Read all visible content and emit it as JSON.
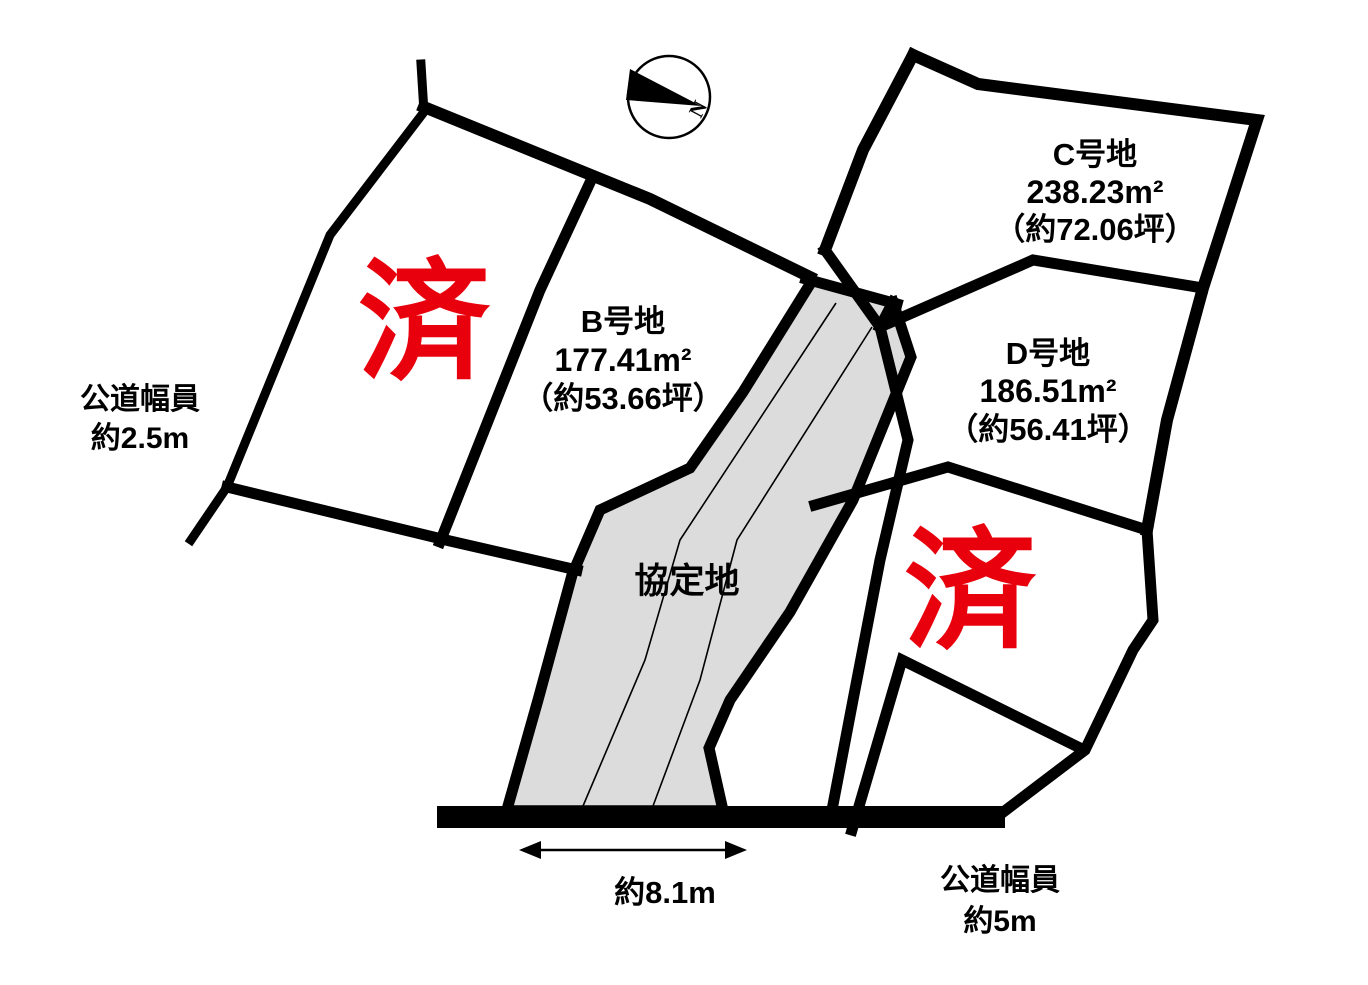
{
  "compass": {
    "north": "N"
  },
  "plots": {
    "b": {
      "name": "B号地",
      "area": "177.41m²",
      "tsubo": "（約53.66坪）"
    },
    "c": {
      "name": "C号地",
      "area": "238.23m²",
      "tsubo": "（約72.06坪）"
    },
    "d": {
      "name": "D号地",
      "area": "186.51m²",
      "tsubo": "（約56.41坪）"
    },
    "agreement": {
      "name": "協定地"
    },
    "sold_left": "済",
    "sold_right": "済"
  },
  "roads": {
    "left": {
      "name": "公道幅員",
      "width": "約2.5m"
    },
    "bottom": {
      "name": "公道幅員",
      "width": "約5m"
    }
  },
  "dimension": {
    "frontage": "約8.1m"
  },
  "colors": {
    "sold_red": "#e8000d",
    "agreement_fill": "#dcdcdc",
    "line_black": "#000000",
    "background": "#ffffff"
  }
}
